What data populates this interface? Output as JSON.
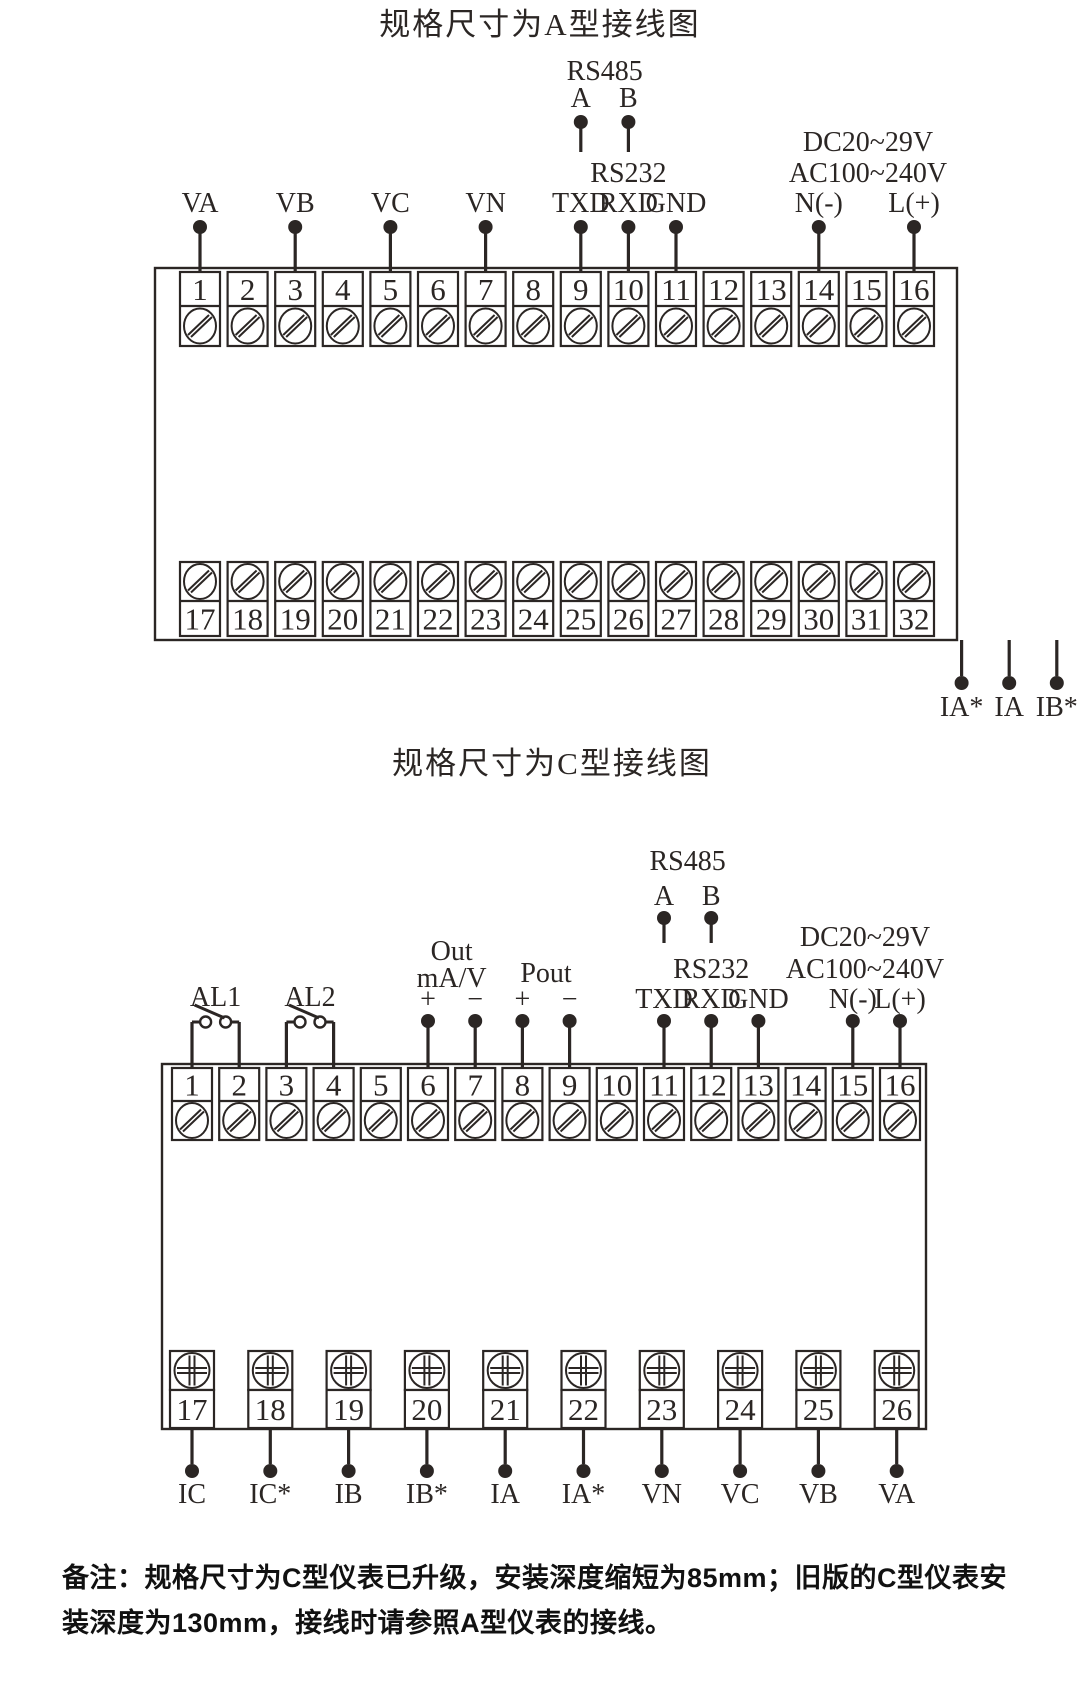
{
  "page": {
    "background": "#ffffff",
    "line_color": "#2b2624"
  },
  "diagram_a": {
    "title": "规格尺寸为A型接线图",
    "top_terminals": [
      "1",
      "2",
      "3",
      "4",
      "5",
      "6",
      "7",
      "8",
      "9",
      "10",
      "11",
      "12",
      "13",
      "14",
      "15",
      "16"
    ],
    "bottom_terminals": [
      "17",
      "18",
      "19",
      "20",
      "21",
      "22",
      "23",
      "24",
      "25",
      "26",
      "27",
      "28",
      "29",
      "30",
      "31",
      "32"
    ],
    "voltage_pins": [
      {
        "label": "VA",
        "terminal": 1
      },
      {
        "label": "VB",
        "terminal": 3
      },
      {
        "label": "VC",
        "terminal": 5
      },
      {
        "label": "VN",
        "terminal": 7
      }
    ],
    "rs485": {
      "label": "RS485",
      "pins": [
        {
          "label": "A",
          "terminal": 9
        },
        {
          "label": "B",
          "terminal": 10
        }
      ]
    },
    "rs232": {
      "label": "RS232",
      "pins": [
        {
          "label": "TXD",
          "terminal": 9
        },
        {
          "label": "RXD",
          "terminal": 10
        },
        {
          "label": "GND",
          "terminal": 11
        }
      ]
    },
    "power": {
      "line1": "DC20~29V",
      "line2": "AC100~240V",
      "pins": [
        {
          "label": "N(-)",
          "terminal": 14
        },
        {
          "label": "L(+)",
          "terminal": 16
        }
      ]
    },
    "current_pins": [
      {
        "label": "IA*",
        "terminal": 17
      },
      {
        "label": "IA",
        "terminal": 18
      },
      {
        "label": "IB*",
        "terminal": 19
      },
      {
        "label": "IB",
        "terminal": 20
      },
      {
        "label": "IC*",
        "terminal": 21
      },
      {
        "label": "IC",
        "terminal": 22
      }
    ],
    "analog_out": {
      "plus": "+",
      "minus": "−",
      "line1": "Out",
      "line2": "mA/V",
      "plus_terminal": 23,
      "minus_terminal": 24
    },
    "pulse_out": {
      "plus": "+",
      "minus": "−",
      "label": "Pout",
      "plus_terminal": 25,
      "minus_terminal": 26
    },
    "relays": [
      {
        "label": "AL1",
        "contacts": [
          "NO",
          "NC"
        ],
        "terminals": [
          27,
          28,
          29
        ]
      },
      {
        "label": "AL2",
        "contacts": [
          "NO",
          "NC"
        ],
        "terminals": [
          30,
          31,
          32
        ]
      }
    ]
  },
  "diagram_c": {
    "title": "规格尺寸为C型接线图",
    "top_terminals": [
      "1",
      "2",
      "3",
      "4",
      "5",
      "6",
      "7",
      "8",
      "9",
      "10",
      "11",
      "12",
      "13",
      "14",
      "15",
      "16"
    ],
    "bottom_terminals": [
      "17",
      "18",
      "19",
      "20",
      "21",
      "22",
      "23",
      "24",
      "25",
      "26"
    ],
    "relay_switches": [
      {
        "label": "AL1",
        "terminals": [
          1,
          2
        ]
      },
      {
        "label": "AL2",
        "terminals": [
          3,
          4
        ]
      }
    ],
    "analog_out": {
      "line1": "Out",
      "line2": "mA/V",
      "plus": "+",
      "minus": "−",
      "plus_terminal": 6,
      "minus_terminal": 7
    },
    "pulse_out": {
      "label": "Pout",
      "plus": "+",
      "minus": "−",
      "plus_terminal": 8,
      "minus_terminal": 9
    },
    "rs485": {
      "label": "RS485",
      "pins": [
        {
          "label": "A",
          "terminal": 11
        },
        {
          "label": "B",
          "terminal": 12
        }
      ]
    },
    "rs232": {
      "label": "RS232",
      "pins": [
        {
          "label": "TXD",
          "terminal": 11
        },
        {
          "label": "RXD",
          "terminal": 12
        },
        {
          "label": "GND",
          "terminal": 13
        }
      ]
    },
    "power": {
      "line1": "DC20~29V",
      "line2": "AC100~240V",
      "pins": [
        {
          "label": "N(-)",
          "terminal": 15
        },
        {
          "label": "L(+)",
          "terminal": 16
        }
      ]
    },
    "bottom_pins": [
      {
        "label": "IC",
        "terminal": 17
      },
      {
        "label": "IC*",
        "terminal": 18
      },
      {
        "label": "IB",
        "terminal": 19
      },
      {
        "label": "IB*",
        "terminal": 20
      },
      {
        "label": "IA",
        "terminal": 21
      },
      {
        "label": "IA*",
        "terminal": 22
      },
      {
        "label": "VN",
        "terminal": 23
      },
      {
        "label": "VC",
        "terminal": 24
      },
      {
        "label": "VB",
        "terminal": 25
      },
      {
        "label": "VA",
        "terminal": 26
      }
    ]
  },
  "note": {
    "text": "备注：规格尺寸为C型仪表已升级，安装深度缩短为85mm；旧版的C型仪表安装深度为130mm，接线时请参照A型仪表的接线。"
  }
}
